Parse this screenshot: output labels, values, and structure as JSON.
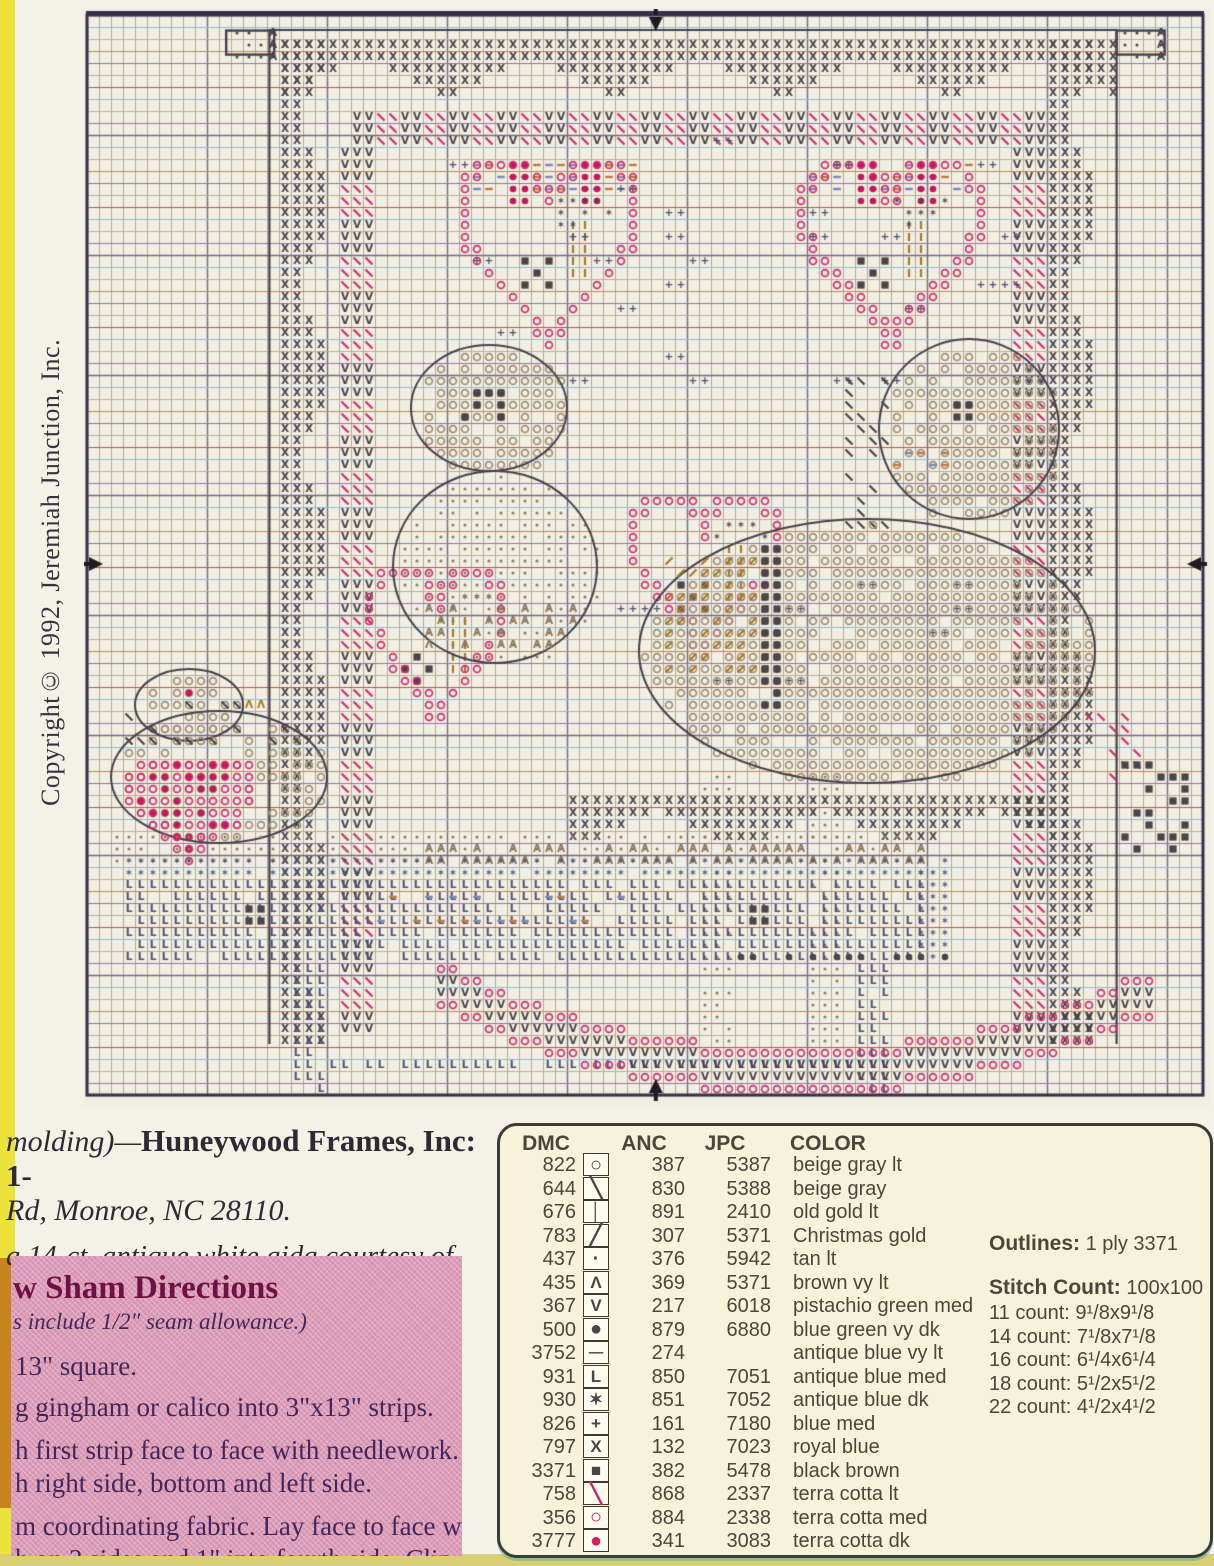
{
  "page_type": "cross-stitch pattern page",
  "copyright": "Copyright© 1992, Jeremiah Junction, Inc.",
  "notes": {
    "line1_italic": "molding)—",
    "line1_bold": "Huneywood Frames, Inc: 1-",
    "line2": "Rd, Monroe, NC 28110.",
    "line3_prefix": "a ",
    "line3": "14-ct. antique white aida courtesy of"
  },
  "directions": {
    "heading_fragment": "w ",
    "heading": "Sham Directions",
    "subheading": "s include 1/2\" seam allowance.)",
    "lines": [
      "13\" square.",
      "g gingham or calico into 3\"x13\" strips.",
      "h first strip face to face with needlework.",
      "h right side,  bottom and left side.",
      "m coordinating fabric. Lay face to face with",
      "h on 3 sides and 1\" into fourth side. Clip cor-",
      "rt 12\" pillow form and slipstitch closed."
    ]
  },
  "legend": {
    "headers": [
      "DMC",
      "ANC",
      "JPC",
      "COLOR"
    ],
    "rows": [
      {
        "dmc": "822",
        "glyph": "○",
        "symbol": "circle-outline",
        "pink": false,
        "anc": "387",
        "jpc": "5387",
        "color": "beige gray lt"
      },
      {
        "dmc": "644",
        "glyph": "╲",
        "symbol": "backslash",
        "pink": false,
        "anc": "830",
        "jpc": "5388",
        "color": "beige gray"
      },
      {
        "dmc": "676",
        "glyph": "│",
        "symbol": "vertical-bar",
        "pink": false,
        "anc": "891",
        "jpc": "2410",
        "color": "old gold lt"
      },
      {
        "dmc": "783",
        "glyph": "╱",
        "symbol": "slash",
        "pink": false,
        "anc": "307",
        "jpc": "5371",
        "color": "Christmas gold"
      },
      {
        "dmc": "437",
        "glyph": "·",
        "symbol": "dot",
        "pink": false,
        "anc": "376",
        "jpc": "5942",
        "color": "tan lt"
      },
      {
        "dmc": "435",
        "glyph": "Λ",
        "symbol": "caret",
        "pink": false,
        "anc": "369",
        "jpc": "5371",
        "color": "brown vy lt"
      },
      {
        "dmc": "367",
        "glyph": "V",
        "symbol": "vee",
        "pink": false,
        "anc": "217",
        "jpc": "6018",
        "color": "pistachio green med"
      },
      {
        "dmc": "500",
        "glyph": "●",
        "symbol": "filled-circle",
        "pink": false,
        "anc": "879",
        "jpc": "6880",
        "color": "blue green vy dk"
      },
      {
        "dmc": "3752",
        "glyph": "─",
        "symbol": "dash",
        "pink": false,
        "anc": "274",
        "jpc": "",
        "color": "antique blue vy lt"
      },
      {
        "dmc": "931",
        "glyph": "L",
        "symbol": "letter-L",
        "pink": false,
        "anc": "850",
        "jpc": "7051",
        "color": "antique blue med"
      },
      {
        "dmc": "930",
        "glyph": "✶",
        "symbol": "star",
        "pink": false,
        "anc": "851",
        "jpc": "7052",
        "color": "antique blue dk"
      },
      {
        "dmc": "826",
        "glyph": "+",
        "symbol": "plus",
        "pink": false,
        "anc": "161",
        "jpc": "7180",
        "color": "blue med"
      },
      {
        "dmc": "797",
        "glyph": "X",
        "symbol": "letter-X",
        "pink": false,
        "anc": "132",
        "jpc": "7023",
        "color": "royal blue"
      },
      {
        "dmc": "3371",
        "glyph": "■",
        "symbol": "filled-square",
        "pink": false,
        "anc": "382",
        "jpc": "5478",
        "color": "black brown"
      },
      {
        "dmc": "758",
        "glyph": "╲",
        "symbol": "backslash-pink",
        "pink": true,
        "anc": "868",
        "jpc": "2337",
        "color": "terra cotta lt"
      },
      {
        "dmc": "356",
        "glyph": "○",
        "symbol": "circle-outline-pink",
        "pink": true,
        "anc": "884",
        "jpc": "2338",
        "color": "terra cotta med"
      },
      {
        "dmc": "3777",
        "glyph": "●",
        "symbol": "filled-circle-pink",
        "pink": true,
        "anc": "341",
        "jpc": "3083",
        "color": "terra cotta dk"
      }
    ],
    "outlines_label": "Outlines:",
    "outlines_value": " 1 ply 3371",
    "stitch_label": "Stitch Count:",
    "stitch_value": " 100x100",
    "counts": [
      "11 count: 9¹/8x9¹/8",
      "14 count: 7¹/8x7¹/8",
      "16 count: 6¹/4x6¹/4",
      "18 count: 5¹/2x5¹/2",
      "22 count: 4¹/2x4¹/2"
    ]
  },
  "chart": {
    "grid": {
      "cols": 93,
      "rows": 90,
      "cell": 12,
      "bg": "#f1eee3",
      "minor_v": "#b2ab94",
      "major": "#6f6a7e",
      "minor_h_cycle": [
        "#b9b099",
        "#8fc0d8",
        "#b9b099",
        "#c08a52",
        "#9a71a8",
        "#b9b099",
        "#b25a50",
        "#8fc0d8",
        "#b9b099",
        "#9a71a8"
      ],
      "frame": "#35314a"
    },
    "palette": {
      "dark": "#4a4348",
      "pink": "#cf2f6e",
      "red": "#c5175c",
      "gold": "#a67b22",
      "blue": "#4e5170",
      "tan": "#8d7b5d",
      "beige": "#a39077",
      "dashA": "#bf7a3d",
      "dashB": "#7c88bd",
      "outline": "#46404a",
      "arrow": "#1e1c20"
    },
    "arrows": {
      "top_col": 46.9,
      "bottom_col": 46.9,
      "side_row": 45.25
    },
    "regions": [
      {
        "name": "corner-box-left",
        "mode": "box",
        "sym": "·",
        "color": "dark",
        "col": 11.6,
        "row": 1.3,
        "w": 4,
        "h": 2,
        "d": 0.8
      },
      {
        "name": "corner-box-right",
        "mode": "box",
        "sym": "·",
        "color": "dark",
        "col": 85.8,
        "row": 1.3,
        "w": 4,
        "h": 2,
        "d": 0.8
      },
      {
        "name": "design-border",
        "mode": "outline",
        "col": 15.2,
        "row": 1.25,
        "w": 70.6,
        "h": 84.5
      },
      {
        "name": "top-swag",
        "mode": "chevron",
        "sym": "X",
        "color": "dark",
        "col": 15.6,
        "row": 1.5,
        "w": 70,
        "h": 6,
        "period": 14,
        "amp": 3.5
      },
      {
        "name": "left-swag",
        "mode": "chevronV",
        "sym": "X",
        "color": "dark",
        "col": 15.5,
        "row": 1.5,
        "w": 5.6,
        "h": 84,
        "period": 14,
        "amp": 3.2
      },
      {
        "name": "right-swag",
        "mode": "chevronV",
        "sym": "X",
        "color": "dark",
        "col": 80.2,
        "row": 1.5,
        "w": 5.4,
        "h": 84,
        "period": 14,
        "amp": 3.2
      },
      {
        "name": "top-vine",
        "mode": "hband",
        "symA": "V",
        "colorA": "dark",
        "symB": "\\",
        "colorB": "pink",
        "col": 21.6,
        "row": 7.8,
        "w": 58.4,
        "h": 3,
        "group": 2
      },
      {
        "name": "left-vine",
        "mode": "vband",
        "symA": "V",
        "colorA": "dark",
        "symB": "\\",
        "colorB": "pink",
        "col": 20.8,
        "row": 11,
        "w": 3,
        "h": 74,
        "group": 3
      },
      {
        "name": "right-vine",
        "mode": "vband",
        "symA": "V",
        "colorA": "dark",
        "symB": "\\",
        "colorB": "pink",
        "col": 76.6,
        "row": 11,
        "w": 3,
        "h": 74,
        "group": 3
      },
      {
        "name": "heart-top-left",
        "mode": "heart",
        "deco": "full",
        "col": 30.5,
        "row": 10.8,
        "w": 16,
        "h": 17.5
      },
      {
        "name": "heart-top-right",
        "mode": "heart",
        "deco": "full",
        "col": 59,
        "row": 10.8,
        "w": 16,
        "h": 17.5
      },
      {
        "name": "heart-mid-left",
        "mode": "heart",
        "deco": "plain",
        "col": 23.2,
        "row": 44.5,
        "w": 12,
        "h": 15
      },
      {
        "name": "heart-mid-right",
        "mode": "heart",
        "deco": "plain",
        "col": 45,
        "row": 38.5,
        "w": 13,
        "h": 15.5
      },
      {
        "name": "plus-field-top",
        "mode": "pluspairs",
        "col": 24,
        "row": 10,
        "w": 56,
        "h": 22,
        "d": 0.1
      },
      {
        "name": "plus-field-mid",
        "mode": "pluspairs",
        "col": 44,
        "row": 47,
        "w": 34,
        "h": 14,
        "d": 0.08
      },
      {
        "name": "bear-head",
        "mode": "blob",
        "sym": "O",
        "color": "beige",
        "col": 27,
        "row": 27.5,
        "w": 13,
        "h": 10.5,
        "d": 0.8
      },
      {
        "name": "bear-eyes",
        "mode": "fill",
        "sym": "■",
        "color": "dark",
        "col": 30.5,
        "row": 30.5,
        "w": 5.5,
        "h": 3,
        "d": 0.55
      },
      {
        "name": "bear-body",
        "mode": "blob",
        "sym": "·",
        "color": "tan",
        "col": 25.5,
        "row": 38,
        "w": 17,
        "h": 16,
        "d": 0.8
      },
      {
        "name": "bear-arm-carets",
        "mode": "fill",
        "sym": "Λ",
        "color": "tan",
        "col": 27,
        "row": 49,
        "w": 14,
        "h": 4,
        "d": 0.5
      },
      {
        "name": "horse-head",
        "mode": "blob",
        "sym": "O",
        "color": "beige",
        "col": 66,
        "row": 27,
        "w": 15,
        "h": 15,
        "d": 0.8
      },
      {
        "name": "horse-eye",
        "mode": "fill",
        "sym": "■",
        "color": "dark",
        "col": 71.5,
        "row": 31.5,
        "w": 2,
        "h": 2,
        "d": 1
      },
      {
        "name": "horse-muzzle",
        "mode": "fill",
        "sym": "—",
        "color": "mixdash",
        "col": 66.5,
        "row": 36,
        "w": 5,
        "h": 2,
        "d": 0.8
      },
      {
        "name": "horse-mane",
        "mode": "fill",
        "sym": "\\",
        "color": "dark",
        "col": 62.5,
        "row": 29,
        "w": 4,
        "h": 14,
        "d": 0.45
      },
      {
        "name": "horse-body",
        "mode": "blob",
        "sym": "O",
        "color": "beige",
        "col": 46,
        "row": 42,
        "w": 38,
        "h": 22,
        "d": 0.85
      },
      {
        "name": "saddle-blanket",
        "mode": "fill",
        "sym": "/",
        "color": "gold",
        "col": 48,
        "row": 45,
        "w": 9,
        "h": 10,
        "d": 0.5
      },
      {
        "name": "girth-strap",
        "mode": "fill",
        "sym": "■",
        "color": "dark",
        "col": 56,
        "row": 44,
        "w": 1.3,
        "h": 14,
        "d": 0.95
      },
      {
        "name": "tail-slashes",
        "mode": "fill",
        "sym": "\\",
        "color": "pink",
        "col": 83,
        "row": 58,
        "w": 5,
        "h": 6,
        "d": 0.4
      },
      {
        "name": "horse-tail",
        "mode": "fill",
        "sym": "■",
        "color": "dark",
        "col": 85.5,
        "row": 62,
        "w": 6,
        "h": 8,
        "d": 0.5
      },
      {
        "name": "front-leg",
        "mode": "fill",
        "sym": "·",
        "color": "tan",
        "col": 50.5,
        "row": 63,
        "w": 3,
        "h": 23,
        "d": 0.8
      },
      {
        "name": "hind-leg",
        "mode": "fill",
        "sym": "·",
        "color": "tan",
        "col": 60,
        "row": 63,
        "w": 3,
        "h": 23,
        "d": 0.8
      },
      {
        "name": "bottom-swag",
        "mode": "chevron",
        "sym": "X",
        "color": "dark",
        "col": 40,
        "row": 64.5,
        "w": 42,
        "h": 5.5,
        "period": 14,
        "amp": 3
      },
      {
        "name": "goose-head",
        "mode": "blob",
        "sym": "O",
        "color": "beige",
        "col": 4,
        "row": 54.5,
        "w": 9,
        "h": 6,
        "d": 0.8
      },
      {
        "name": "goose-eye",
        "mode": "fill",
        "sym": "●",
        "color": "red",
        "col": 7.5,
        "row": 55.5,
        "w": 1,
        "h": 1,
        "d": 1
      },
      {
        "name": "goose-beak",
        "mode": "fill",
        "sym": "Λ",
        "color": "gold",
        "col": 12.5,
        "row": 56.5,
        "w": 2,
        "h": 1.5,
        "d": 1
      },
      {
        "name": "goose-body",
        "mode": "blob",
        "sym": "O",
        "color": "beige",
        "col": 2,
        "row": 58,
        "w": 18,
        "h": 11,
        "d": 0.5
      },
      {
        "name": "goose-slashes",
        "mode": "fill",
        "sym": "\\",
        "color": "dark",
        "col": 3,
        "row": 57,
        "w": 15,
        "h": 4,
        "d": 0.3
      },
      {
        "name": "goose-wing-heart",
        "mode": "heartSolid",
        "col": 3.2,
        "row": 60.5,
        "w": 11,
        "h": 10.5
      },
      {
        "name": "rug-dots",
        "mode": "fill",
        "sym": "·",
        "color": "tan",
        "col": 2,
        "row": 68.3,
        "w": 68,
        "h": 2,
        "d": 0.85
      },
      {
        "name": "rug-carets",
        "mode": "fill",
        "sym": "Λ",
        "color": "tan",
        "col": 28,
        "row": 69.3,
        "w": 42,
        "h": 1.2,
        "d": 0.7
      },
      {
        "name": "platform-star-row",
        "mode": "fill",
        "sym": "✶",
        "color": "blue",
        "col": 2.8,
        "row": 70.4,
        "w": 67,
        "h": 1.2,
        "d": 0.95
      },
      {
        "name": "platform",
        "mode": "fill",
        "sym": "L",
        "color": "blue",
        "col": 3.4,
        "row": 71.6,
        "w": 66,
        "h": 6.8,
        "d": 0.9
      },
      {
        "name": "platform-dashes",
        "mode": "fill",
        "sym": "—",
        "color": "mixdash",
        "col": 24,
        "row": 73,
        "w": 22,
        "h": 3,
        "d": 0.35
      },
      {
        "name": "platform-star-right",
        "mode": "fill",
        "sym": "✶",
        "color": "blue",
        "col": 69.3,
        "row": 70.4,
        "w": 2.4,
        "h": 8,
        "d": 0.9
      },
      {
        "name": "platform-knob-left",
        "mode": "fill",
        "sym": "■",
        "color": "dark",
        "col": 13,
        "row": 74,
        "w": 1.2,
        "h": 1.2,
        "d": 1
      },
      {
        "name": "platform-knob-right",
        "mode": "fill",
        "sym": "■",
        "color": "dark",
        "col": 55,
        "row": 74,
        "w": 1.2,
        "h": 1.2,
        "d": 1
      },
      {
        "name": "left-leg",
        "mode": "fill",
        "sym": "L",
        "color": "blue",
        "col": 16.8,
        "row": 79,
        "w": 2.6,
        "h": 11,
        "d": 0.9
      },
      {
        "name": "right-leg",
        "mode": "fill",
        "sym": "L",
        "color": "blue",
        "col": 63.8,
        "row": 79,
        "w": 2.6,
        "h": 11,
        "d": 0.9
      },
      {
        "name": "crossbar",
        "mode": "fill",
        "sym": "L",
        "color": "blue",
        "col": 19.4,
        "row": 86.6,
        "w": 44.4,
        "h": 1.4,
        "d": 0.8
      },
      {
        "name": "rocker",
        "mode": "arc",
        "col": 29,
        "row": 80,
        "w": 59,
        "h": 10
      },
      {
        "name": "rocker-dots",
        "mode": "fill",
        "sym": "●",
        "color": "dark",
        "col": 52,
        "row": 77.5,
        "w": 20,
        "h": 1.5,
        "d": 0.4
      }
    ]
  }
}
